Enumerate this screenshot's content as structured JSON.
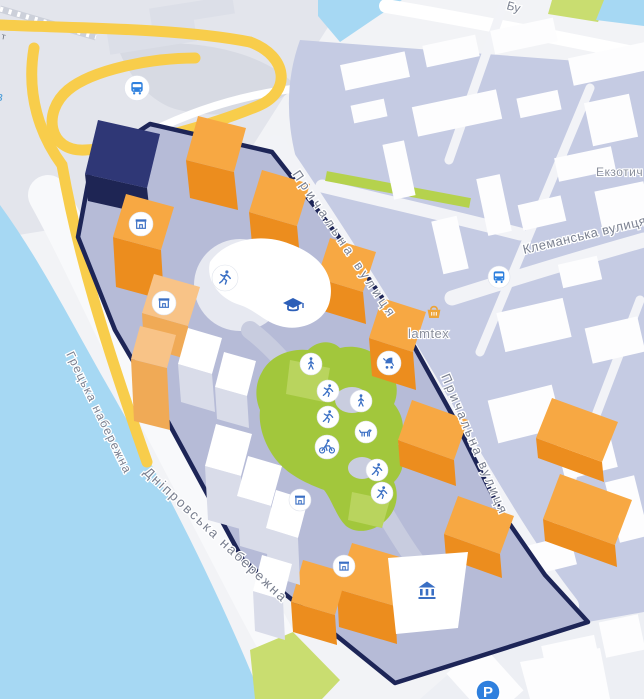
{
  "map": {
    "type": "city-map-3d-masterplan",
    "labels": {
      "prychalna_street_1": "Причальна вулиця",
      "prychalna_street_2": "Причальна вулиця",
      "klemanska_street": "Клеманська вулиця",
      "hretska_embankment": "Грецька набережна",
      "dniprovska_embankment": "Дніпровська набережна",
      "ekzotych_partial": "Екзотич",
      "lamtex_poi": "lamtex",
      "bu_street_partial": "Бу",
      "t_road_partial": "т",
      "water_label_partial": "в",
      "parking_letter": "P"
    },
    "colors": {
      "water": "#a6d8f3",
      "road_yellow": "#f8cd4b",
      "district_fill": "#c5cbe3",
      "site_fill": "#b6bbd7",
      "site_border_navy": "#1d2557",
      "building_orange_roof": "#f7a843",
      "building_orange_side": "#ec8d1e",
      "building_peach_roof": "#f8c387",
      "building_navy": "#2f3776",
      "building_white": "#ffffff",
      "park_green": "#a2c73c",
      "park_green_light": "#c9dd70",
      "icon_blue": "#3a6fc4",
      "bus_blue": "#2f80de",
      "basket_orange": "#eda437",
      "street_label_gray": "#7a8090"
    },
    "icons": {
      "bus": "bus-glyph",
      "runner": "running-person-glyph",
      "walker": "walking-person-glyph",
      "cyclist": "bicycle-glyph",
      "stroller": "baby-stroller-glyph",
      "dog": "dog-walking-glyph",
      "kiosk": "storefront-glyph",
      "graduation_cap": "school-glyph",
      "bank": "classical-building-glyph",
      "basket": "shopping-basket-glyph",
      "parking": "letter-p-in-blue-circle"
    }
  }
}
